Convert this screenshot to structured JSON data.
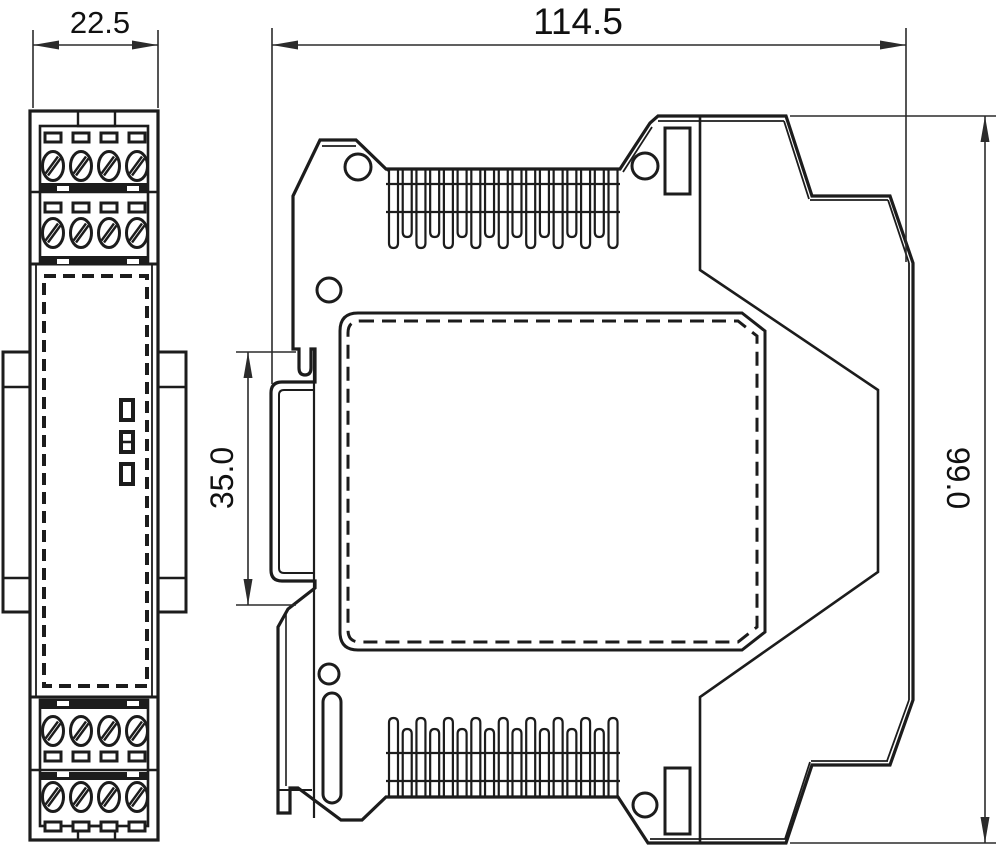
{
  "drawing": {
    "description": "DIN-rail enclosure dimensional drawing, front view and side view",
    "views": {
      "front": {
        "name": "front-view"
      },
      "side": {
        "name": "side-view"
      }
    },
    "dimension_labels": {
      "front_width": "22.5",
      "side_width": "114.5",
      "side_height": "99.0",
      "din_rail_height": "35.0"
    },
    "counts": {
      "vent_slots_top": 17,
      "vent_slots_bottom": 17,
      "terminal_columns": 4,
      "terminal_rows": 4,
      "led_indicators": 3
    },
    "colors": {
      "line": "#1c1c1c",
      "dimension_line": "#2b2b2b",
      "background": "#ffffff",
      "text": "#111111"
    }
  }
}
